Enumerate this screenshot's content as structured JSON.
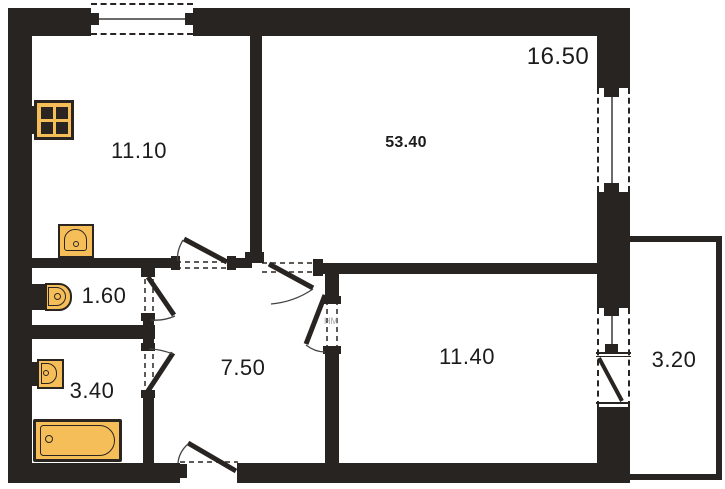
{
  "rooms": {
    "kitchen": {
      "area": "11.10"
    },
    "living_room": {
      "area": "16.50"
    },
    "total": {
      "area": "53.40"
    },
    "wc": {
      "area": "1.60"
    },
    "bathroom": {
      "area": "3.40"
    },
    "hallway": {
      "area": "7.50"
    },
    "bedroom": {
      "area": "11.40"
    },
    "balcony": {
      "area": "3.20"
    }
  },
  "watermark": {
    "text": "HM"
  },
  "icons": [
    "stove-icon",
    "kitchen-sink-icon",
    "toilet-icon",
    "washbasin-icon",
    "bathtub-icon"
  ],
  "colors": {
    "wall": "#282421",
    "fixture_fill": "#F5BE58",
    "fixture_border": "#2a2520",
    "label": "#1b1b1b",
    "background": "#ffffff",
    "watermark": "#8f8f8f",
    "window_line": "#6b6b6b"
  }
}
